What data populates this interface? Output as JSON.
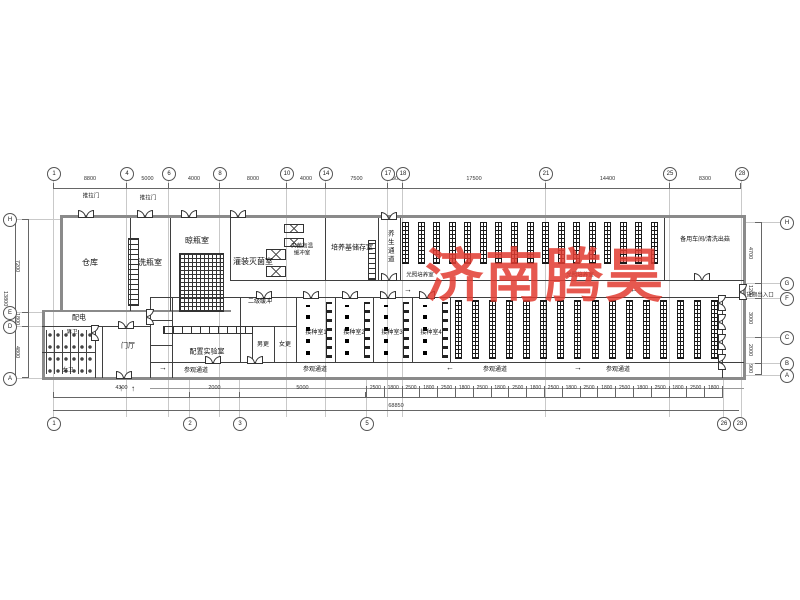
{
  "watermark": {
    "text": "济南腾昊",
    "color": "#e23b31",
    "font_px": 58
  },
  "labels": {
    "warehouse": "仓库",
    "bottle_wash": "洗瓶室",
    "bottle_dry": "晾瓶室",
    "filling": "灌装灭菌室",
    "buffer1": "灭菌高温",
    "buffer2": "缓冲室",
    "medium": "培养基储存室",
    "grow_corridor": "养生通道",
    "spare": "备用车间/清洗出菇",
    "light_room": "光照培养室",
    "sec_buffer": "二级缓冲",
    "power": "配电",
    "m_wc": "男卫",
    "w_wc": "女卫",
    "lobby": "门厅",
    "prep_lab": "配置实验室",
    "m_change": "男更",
    "w_change": "女更",
    "inoc1": "接种室1",
    "inoc2": "接种室2",
    "inoc3": "接种室3",
    "inoc4": "接种室4",
    "visitor": "参观通道",
    "cargo": "货物出入口",
    "sliding": "推拉门"
  },
  "arrows": {
    "left": "←",
    "right": "→",
    "up": "↑"
  },
  "grid": {
    "top": [
      "1",
      "4",
      "6",
      "8",
      "10",
      "14",
      "17",
      "18",
      "21",
      "25",
      "28"
    ],
    "bottom": [
      "1",
      "2",
      "3",
      "5",
      "26",
      "28"
    ],
    "left": [
      "H",
      "E",
      "D",
      "A"
    ],
    "right": [
      "H",
      "G",
      "F",
      "C",
      "B",
      "A"
    ]
  },
  "dims": {
    "top": [
      "8800",
      "5000",
      "4000",
      "8000",
      "4000",
      "7500",
      "1800",
      "17500",
      "14400",
      "8300"
    ],
    "bottom": [
      "4300",
      "2000",
      "5000"
    ],
    "bottom_chain": [
      "2500",
      "1800",
      "2500",
      "1800",
      "2500",
      "1800",
      "2500",
      "1800",
      "2500",
      "1800",
      "2500",
      "1800",
      "2500",
      "1800",
      "2500",
      "1800",
      "2500",
      "1800",
      "2500",
      "1800"
    ],
    "bottom_total": "68850",
    "left": [
      "7200",
      "1800",
      "4800"
    ],
    "left_total": "13800",
    "right": [
      "4700",
      "1200",
      "3000",
      "2000",
      "900"
    ]
  },
  "racks": {
    "upper_strips": 17,
    "lower_strips": 16
  }
}
